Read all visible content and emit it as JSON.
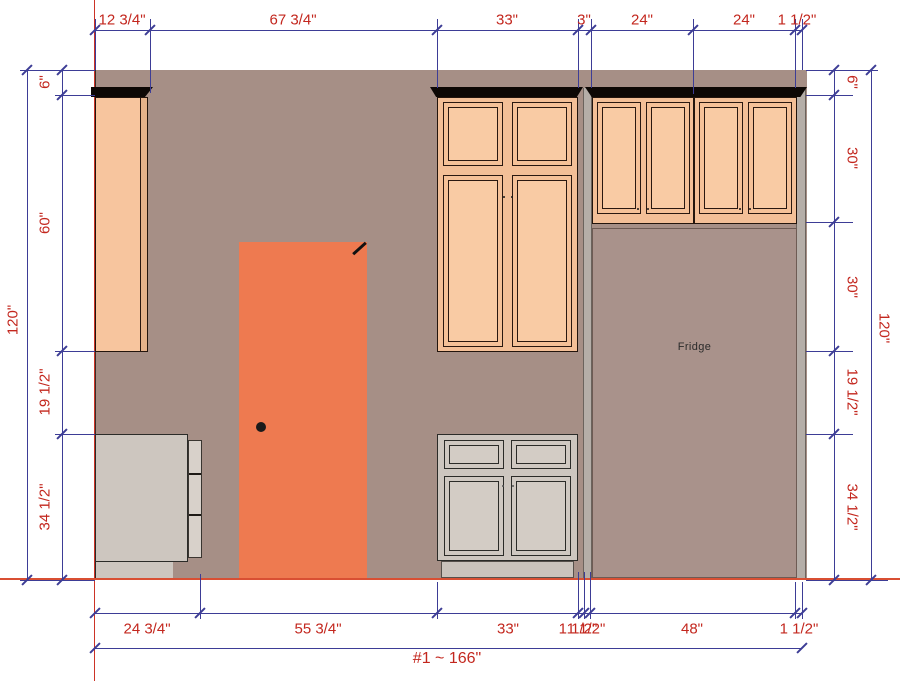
{
  "scene": {
    "fridge_label": "Fridge"
  },
  "dimensions": {
    "top": [
      "12 3/4\"",
      "67 3/4\"",
      "33\"",
      "3\"",
      "24\"",
      "24\"",
      "1 1/2\""
    ],
    "bottom": [
      "24 3/4\"",
      "55 3/4\"",
      "33\"",
      "1 1/2\"",
      "1 1/2\"",
      "48\"",
      "1 1/2\""
    ],
    "left": [
      "6\"",
      "60\"",
      "19 1/2\"",
      "34 1/2\""
    ],
    "left_overall": "120\"",
    "right": [
      "6\"",
      "30\"",
      "30\"",
      "19 1/2\"",
      "34 1/2\""
    ],
    "right_overall": "120\"",
    "total": "#1 ~ 166\""
  },
  "colors": {
    "wall": "#A68F86",
    "cabinet_face": "#F7C59E",
    "door": "#EE7A50",
    "base_cabinet": "#CDC6BF",
    "fridge_area": "#A9928B",
    "crown_molding": "#0D0805",
    "dimension_line": "#3D3D96",
    "dimension_text": "#C3271E",
    "floor_line": "#D94F33"
  }
}
